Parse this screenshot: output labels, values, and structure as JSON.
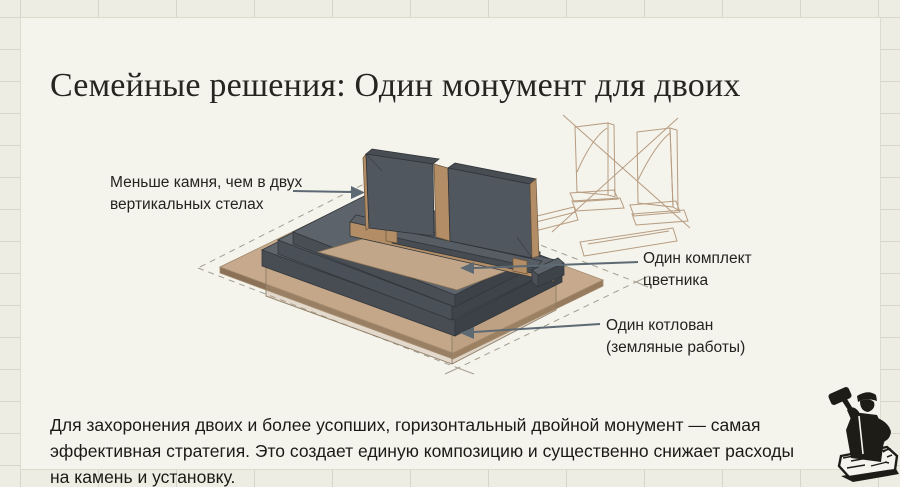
{
  "slide": {
    "title": "Семейные решения: Один монумент для двоих",
    "paragraph": "Для захоронения двоих и более усопших, горизонтальный двойной монумент — самая эффективная стратегия. Это создает единую композицию и существенно снижает расходы на камень и установку."
  },
  "annotations": {
    "less_stone": "Меньше камня, чем в двух\nвертикальных стелах",
    "flowerbed": "Один комплект\nцветника",
    "pit": "Один котлован\n(земляные работы)"
  },
  "illustration": {
    "type": "isometric-technical-drawing",
    "main_object": "horizontal double monument: two dark stelae on one pedestal, one flower-bed frame, stepped base on earth pad with dashed excavation outline",
    "rejected_option": "two separate vertical monuments sketch, crossed out with X"
  },
  "icons": {
    "logo": "stonemason-with-mallet-and-chisel"
  },
  "colors": {
    "panel_background": "#f4f3ec",
    "grid_background": "#eeede4",
    "stone_dark": "#51575e",
    "stone_top": "#474d53",
    "wood_tan": "#b28d66",
    "earth_pad": "#c7aa8d",
    "sketch_line": "#b79c80",
    "arrow": "#5d6a73",
    "ink": "#26251f"
  }
}
